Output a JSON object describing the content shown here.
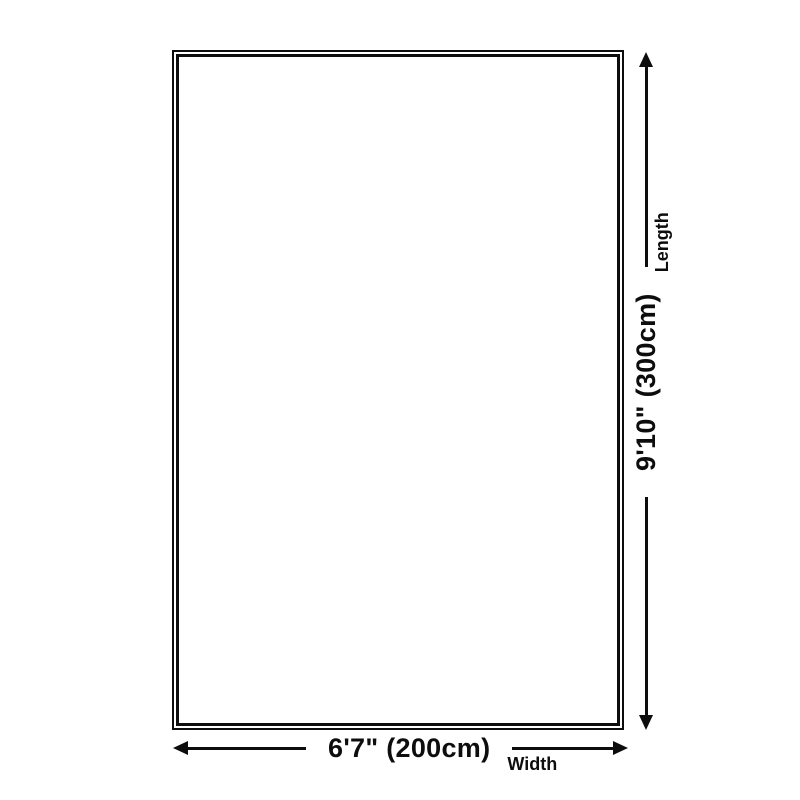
{
  "colors": {
    "background": "#ffffff",
    "line": "#0d0d0d"
  },
  "dimensions": {
    "width": {
      "value": "6'7\" (200cm)",
      "label": "Width"
    },
    "length": {
      "value": "9'10\" (300cm)",
      "label": "Length"
    }
  },
  "icons": {
    "arrow_left": "◀",
    "arrow_right": "▶",
    "arrow_up": "▲",
    "arrow_down": "▼"
  }
}
